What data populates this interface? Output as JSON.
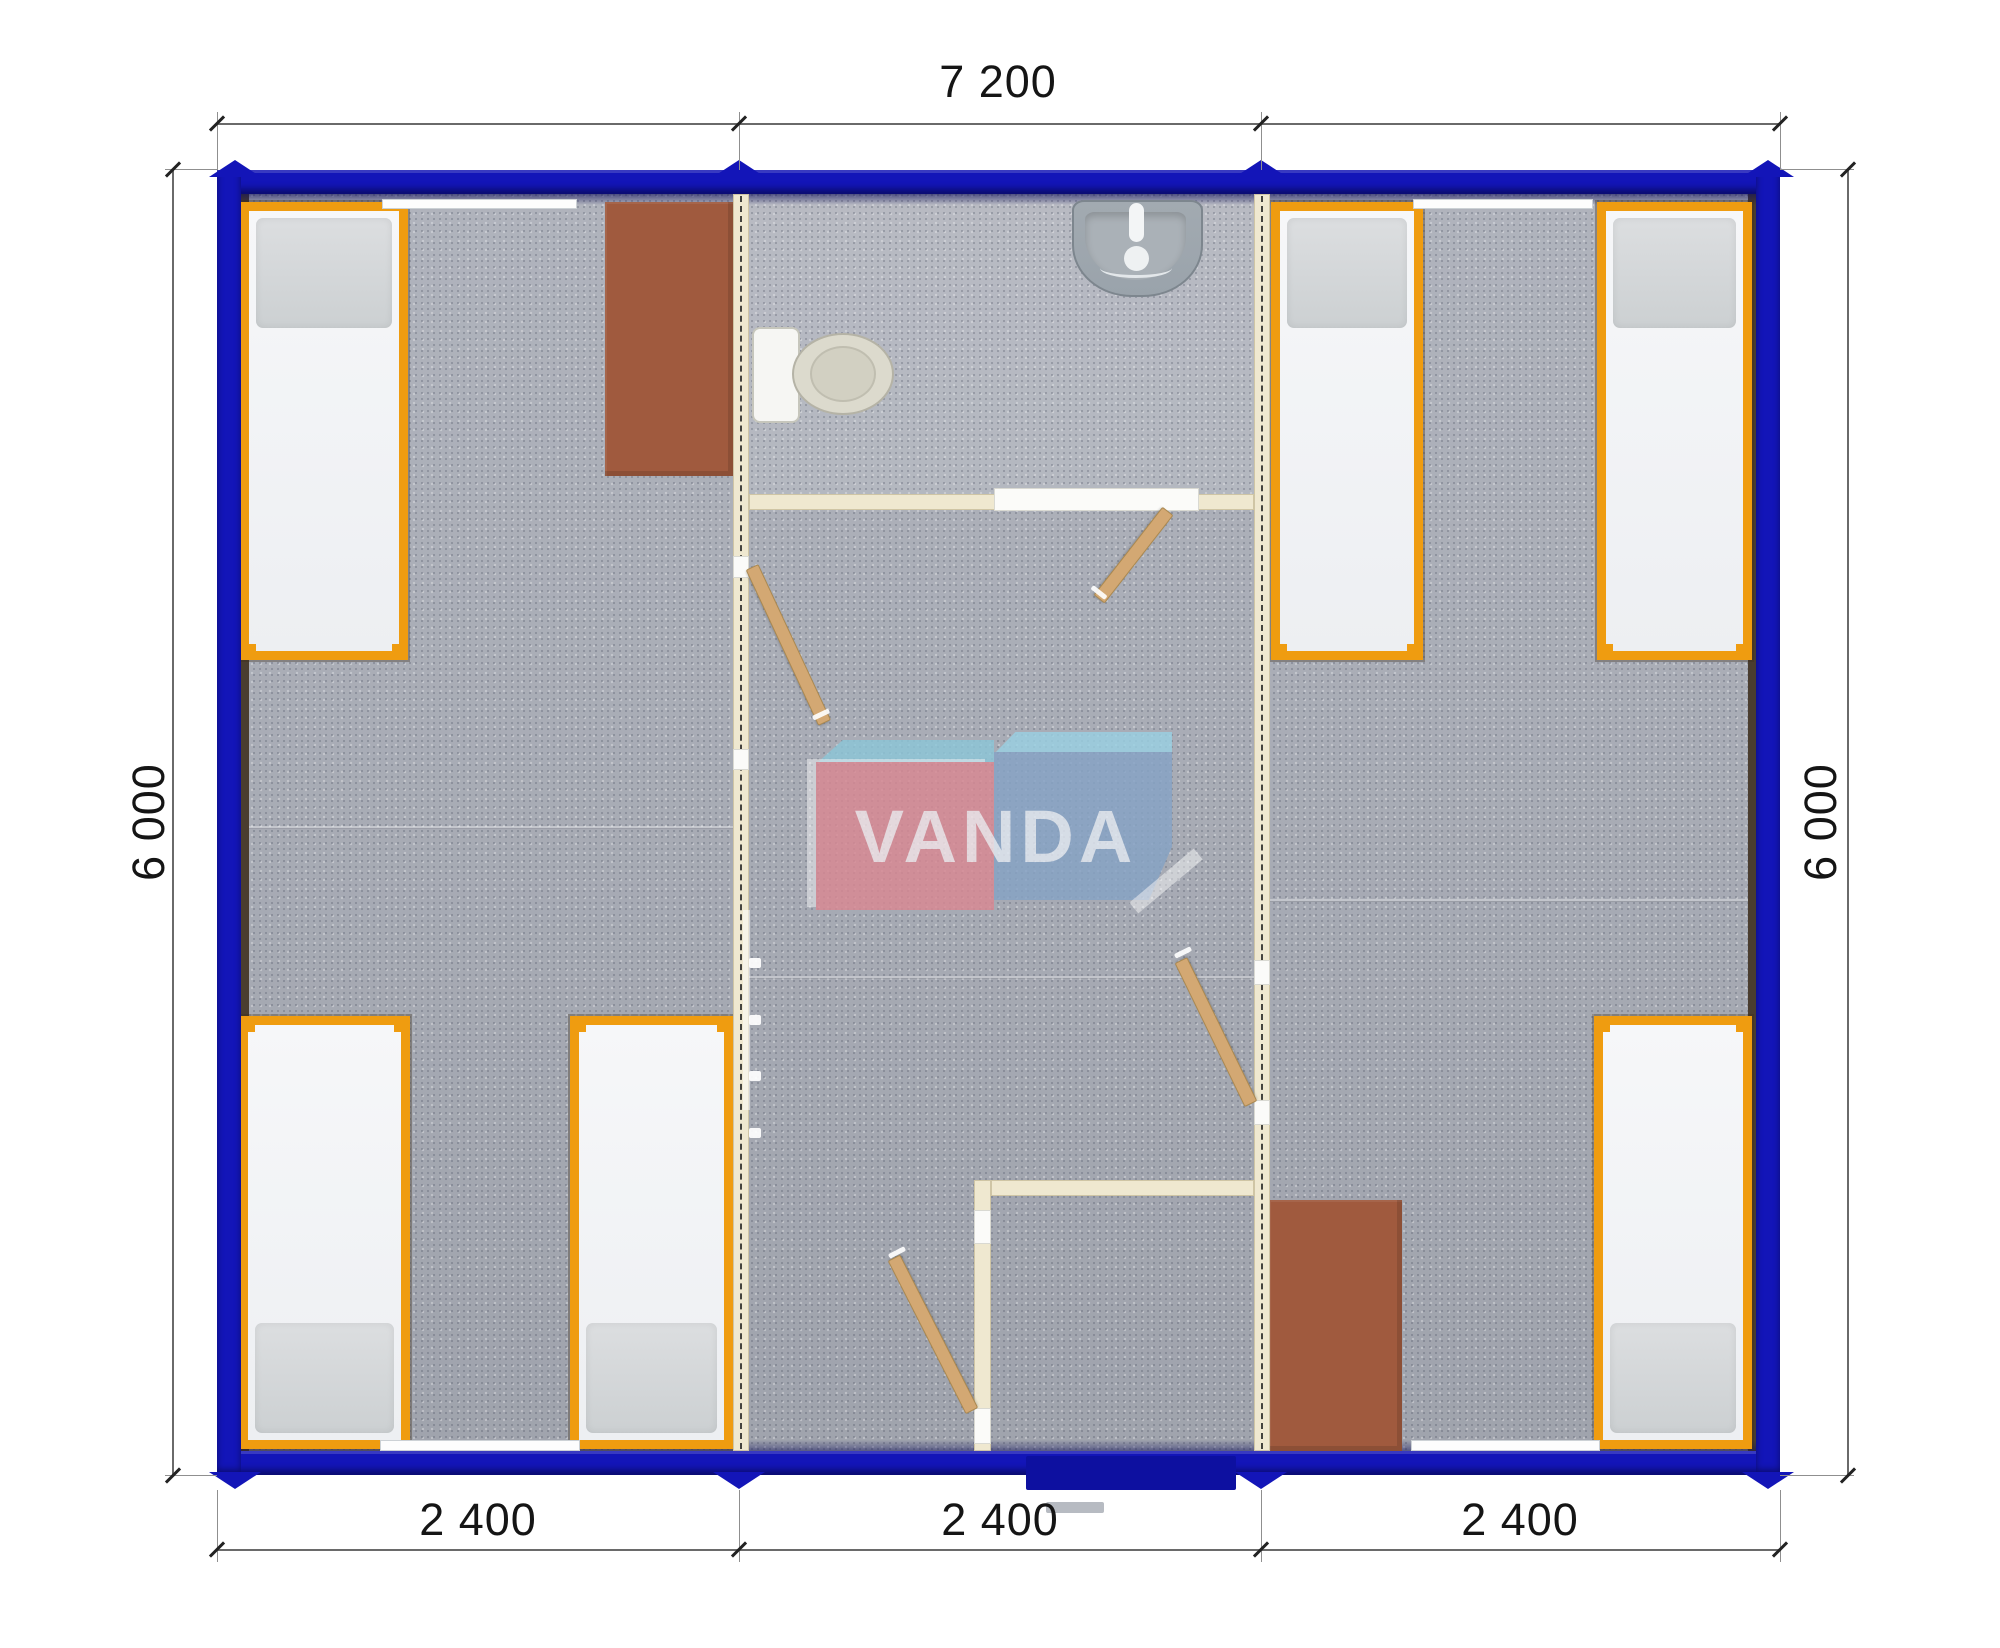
{
  "dimensions": {
    "top": "7 200",
    "bottom": [
      "2 400",
      "2 400",
      "2 400"
    ],
    "left": "6 000",
    "right": "6 000"
  },
  "logo": {
    "text": "VANDA"
  },
  "colors": {
    "blue": "#1315b8",
    "navyBand": "#0d10a0",
    "cream": "#efe8d0",
    "creamEdge": "#cfc5a5",
    "carpet": "#a8acb6",
    "liner": "#4a3d2f",
    "orange": "#ef9c10",
    "pillow": "#ccd0d2",
    "brown": "#a05a3e",
    "wood": "#d3a873",
    "woodEdge": "#ab8950",
    "fixture": "#9aa3ab",
    "toiletBowl": "#dcdacd",
    "step": "#b7bbc2",
    "window": "#fdfdfd",
    "dimLine": "#6a6a6a",
    "dimText": "#151515",
    "logoRed": "#d98892",
    "logoBlue": "#86a3c5",
    "logoTopRed": "#8cc6d8",
    "logoTopBlue": "#9ad0e2"
  }
}
